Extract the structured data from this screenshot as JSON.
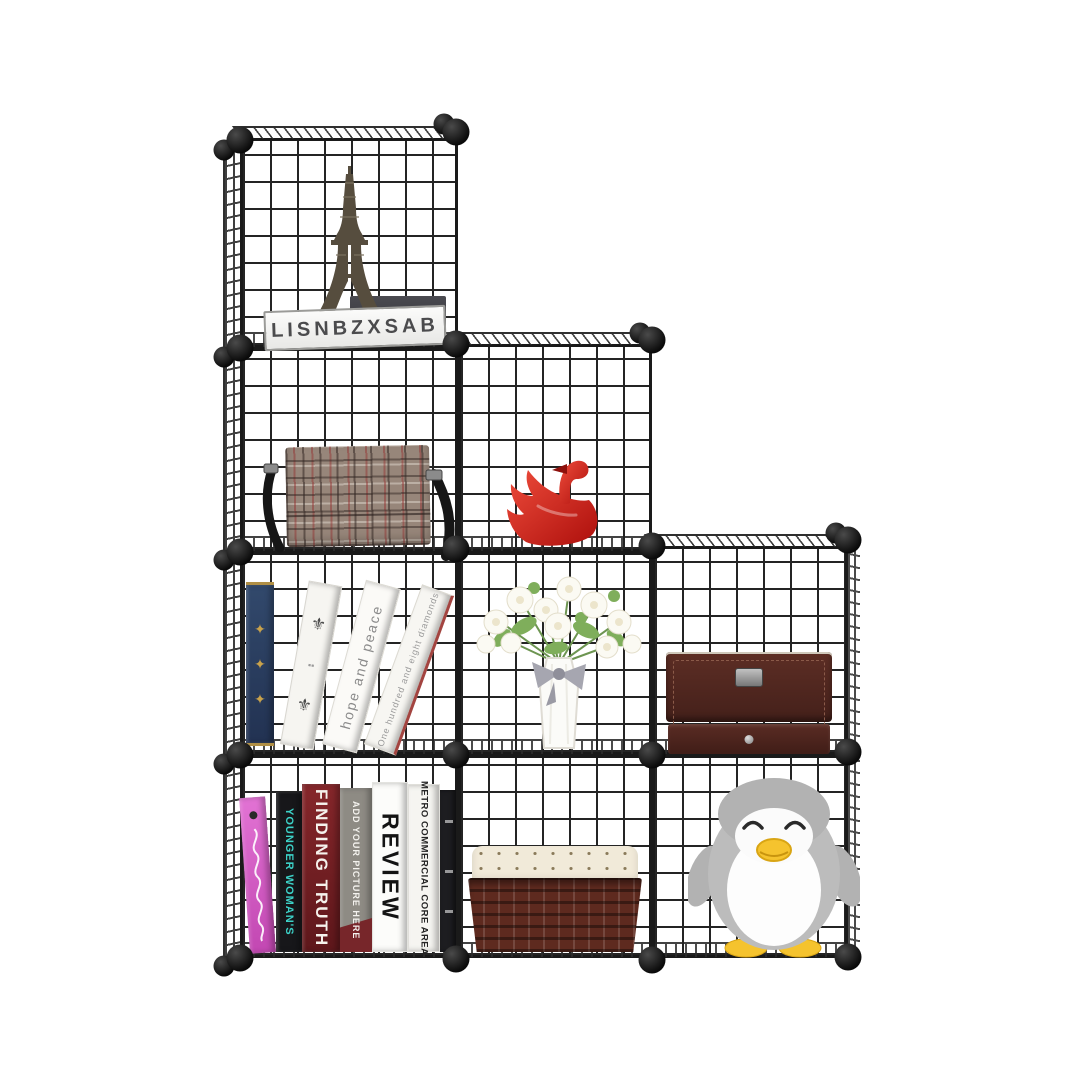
{
  "meta": {
    "type": "product-photo",
    "subject": "Black metal wire-grid 9-cube staircase storage organizer decorated with household items",
    "background": "#ffffff"
  },
  "palette": {
    "wire": "#1f1f1f",
    "connector_ball": "#0d0d0d",
    "swan_red": "#cf1f1a",
    "bag_plaid_base": "#97867a",
    "jewelry_box_brown": "#4e241d",
    "basket_brown": "#5e2a1f",
    "liner_cream": "#f1ead9",
    "penguin_gray": "#bcbcbc",
    "penguin_yellow": "#f5c32e",
    "book_pink": "#d45dc6",
    "book_teal_text": "#3cd2c8",
    "book_dark_red": "#7b2026",
    "book_gray": "#8e8b84",
    "blue_book": "#2f4468",
    "vase_white": "#fbfbf8",
    "ribbon_gray": "#a6a6b0",
    "leaf_green": "#7fae5b"
  },
  "sign": {
    "text": "LISNBZXSAB"
  },
  "books": {
    "hope": "hope and peace",
    "diamonds": "One hundred and eight diamonds",
    "younger": "YOUNGER WOMAN'S",
    "finding": "FINDING TRUTH",
    "add_your": "ADD YOUR PICTURE HERE",
    "review": "REVIEW",
    "metro": "METRO COMMERCIAL CORE AREA",
    "pink_script_note": "illegible white cursive lettering",
    "crest_glyph": "⚜",
    "ornament_glyph": "✦"
  },
  "cubes": {
    "r1c1": "Eiffel Tower figurine with LISNBZXSAB nameplate and dark photo frame",
    "r2c1": "brown plaid crossbody bag with black strap",
    "r2c2": "red ceramic swan figurine",
    "r3c1": "leaning books: blue ornate hardcover, white crest book, hope and peace, One hundred and eight diamonds",
    "r3c2": "white faceted vase with gray ribbon bow and white/green flower bouquet",
    "r3c3": "dark brown leather jewelry box with drawer",
    "r4c1": "row of decorative books",
    "r4c2": "dark brown wicker basket with polka-dot fabric liner",
    "r4c3": "gray plush penguin with yellow beak and feet"
  }
}
